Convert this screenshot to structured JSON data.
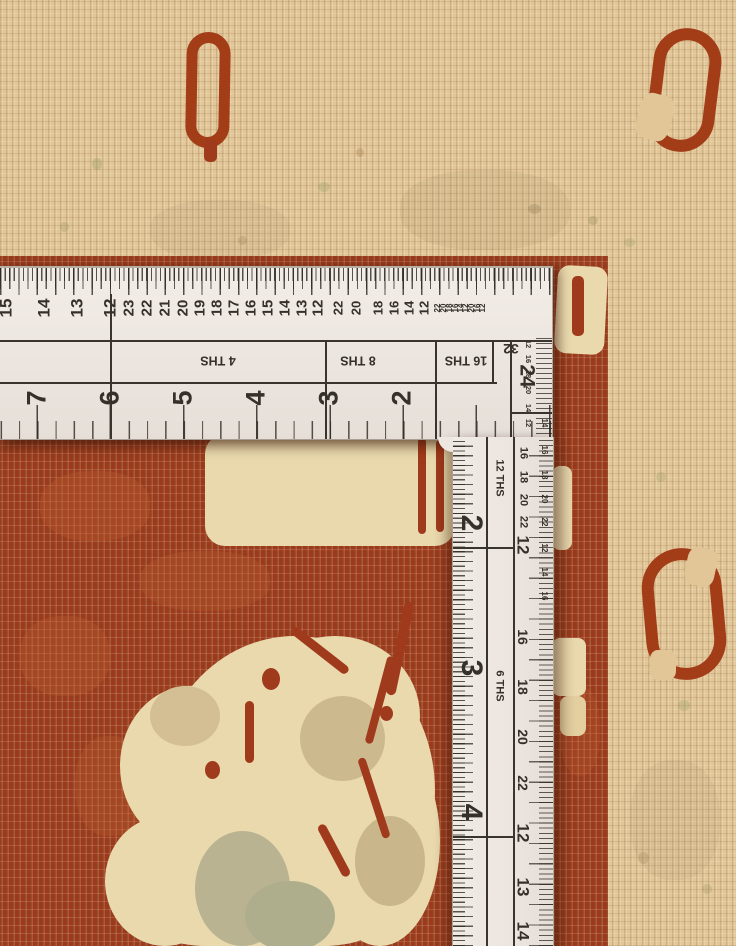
{
  "scene": {
    "description": "Close-up photo of a hand-knotted rug corner with an L-shaped steel framing square laid on it",
    "objects": [
      "rug",
      "framing-square-ruler"
    ]
  },
  "rug": {
    "colors": {
      "border_beige": "#e2c697",
      "field_red": "#9c3a1b",
      "motif_cream": "#e9d9ad",
      "accent_sage": "#b3ae88",
      "accent_tan": "#cdb98e",
      "motif_outline_red": "#a33d18"
    },
    "motifs": [
      "border-bud-top-left",
      "border-bud-top-right",
      "border-bud-right",
      "field-palmette",
      "field-edge-notches"
    ]
  },
  "ruler": {
    "colors": {
      "body": "#ece5df",
      "markings": "#36302a"
    },
    "horizontal_arm": {
      "top_scale": [
        {
          "v": "15",
          "x": 6,
          "cls": "f17"
        },
        {
          "v": "14",
          "x": 44,
          "cls": "f17"
        },
        {
          "v": "13",
          "x": 77,
          "cls": "f17"
        },
        {
          "v": "12",
          "x": 110,
          "cls": "f17"
        },
        {
          "v": "23",
          "x": 129,
          "cls": "f15"
        },
        {
          "v": "22",
          "x": 147,
          "cls": "f15"
        },
        {
          "v": "21",
          "x": 165,
          "cls": "f15"
        },
        {
          "v": "20",
          "x": 183,
          "cls": "f15"
        },
        {
          "v": "19",
          "x": 200,
          "cls": "f15"
        },
        {
          "v": "18",
          "x": 217,
          "cls": "f15"
        },
        {
          "v": "17",
          "x": 234,
          "cls": "f15"
        },
        {
          "v": "16",
          "x": 251,
          "cls": "f15"
        },
        {
          "v": "15",
          "x": 268,
          "cls": "f15"
        },
        {
          "v": "14",
          "x": 285,
          "cls": "f15"
        },
        {
          "v": "13",
          "x": 302,
          "cls": "f15"
        },
        {
          "v": "12",
          "x": 318,
          "cls": "f15"
        },
        {
          "v": "22",
          "x": 338,
          "cls": "f13"
        },
        {
          "v": "20",
          "x": 356,
          "cls": "f13"
        },
        {
          "v": "18",
          "x": 378,
          "cls": "f13"
        },
        {
          "v": "16",
          "x": 394,
          "cls": "f13"
        },
        {
          "v": "14",
          "x": 409,
          "cls": "f13"
        },
        {
          "v": "12",
          "x": 424,
          "cls": "f13"
        },
        {
          "v": "22",
          "x": 438,
          "cls": "f8"
        },
        {
          "v": "20",
          "x": 444,
          "cls": "f8"
        },
        {
          "v": "18",
          "x": 450,
          "cls": "f8"
        },
        {
          "v": "16",
          "x": 456,
          "cls": "f8"
        },
        {
          "v": "14",
          "x": 461,
          "cls": "f8"
        },
        {
          "v": "12",
          "x": 466,
          "cls": "f8"
        },
        {
          "v": "20",
          "x": 472,
          "cls": "f8"
        },
        {
          "v": "16",
          "x": 478,
          "cls": "f8"
        },
        {
          "v": "12",
          "x": 483,
          "cls": "f8"
        }
      ],
      "inch_numbers": [
        {
          "v": "7",
          "x": 37,
          "cls": "f27"
        },
        {
          "v": "6",
          "x": 110,
          "cls": "f27"
        },
        {
          "v": "5",
          "x": 183,
          "cls": "f27"
        },
        {
          "v": "4",
          "x": 256,
          "cls": "f27"
        },
        {
          "v": "3",
          "x": 329,
          "cls": "f27"
        },
        {
          "v": "2",
          "x": 402,
          "cls": "f27"
        }
      ],
      "fraction_cells": [
        {
          "v": "4 THS",
          "x": 218,
          "cls": "f12 r180"
        },
        {
          "v": "8 THS",
          "x": 358,
          "cls": "f12 r180"
        },
        {
          "v": "16 THS",
          "x": 466,
          "cls": "f12 r180"
        }
      ],
      "corner_labels": [
        {
          "v": "32",
          "x": 511,
          "y": 81,
          "cls": "f14 r180"
        },
        {
          "v": "24",
          "x": 527,
          "y": 108,
          "cls": "f20 r90"
        }
      ],
      "corner_tiny_numbers": [
        {
          "v": "12",
          "y": 76,
          "cls": "f7 r90"
        },
        {
          "v": "16",
          "y": 91,
          "cls": "f7 r90"
        },
        {
          "v": "18",
          "y": 106,
          "cls": "f7 r90"
        },
        {
          "v": "20",
          "y": 122,
          "cls": "f7 r90"
        },
        {
          "v": "14",
          "y": 140,
          "cls": "f7 r90"
        },
        {
          "v": "12",
          "y": 155,
          "cls": "f7 r90"
        }
      ]
    },
    "vertical_arm": {
      "inch_numbers": [
        {
          "v": "2",
          "y": 86,
          "cls": "f30 r90"
        },
        {
          "v": "3",
          "y": 231,
          "cls": "f30 r90"
        },
        {
          "v": "4",
          "y": 375,
          "cls": "f30 r90"
        }
      ],
      "fraction_labels": [
        {
          "v": "12 THS",
          "y": 41,
          "cls": "f11 r90"
        },
        {
          "v": "6 THS",
          "y": 249,
          "cls": "f11 r90"
        }
      ],
      "mid_numbers": [
        {
          "v": "16",
          "y": 16,
          "cls": "f11 r90"
        },
        {
          "v": "18",
          "y": 40,
          "cls": "f11 r90"
        },
        {
          "v": "20",
          "y": 63,
          "cls": "f11 r90"
        },
        {
          "v": "22",
          "y": 85,
          "cls": "f11 r90"
        },
        {
          "v": "12",
          "y": 108,
          "cls": "f17 r90"
        },
        {
          "v": "16",
          "y": 200,
          "cls": "f14 r90"
        },
        {
          "v": "18",
          "y": 250,
          "cls": "f14 r90"
        },
        {
          "v": "20",
          "y": 300,
          "cls": "f14 r90"
        },
        {
          "v": "22",
          "y": 346,
          "cls": "f14 r90"
        },
        {
          "v": "12",
          "y": 396,
          "cls": "f17 r90"
        },
        {
          "v": "13",
          "y": 450,
          "cls": "f17 r90"
        },
        {
          "v": "14",
          "y": 494,
          "cls": "f17 r90"
        }
      ],
      "edge_numbers": [
        {
          "v": "14",
          "y": -14,
          "cls": "f8 r90"
        },
        {
          "v": "16",
          "y": 13,
          "cls": "f8 r90"
        },
        {
          "v": "18",
          "y": 38,
          "cls": "f8 r90"
        },
        {
          "v": "20",
          "y": 62,
          "cls": "f8 r90"
        },
        {
          "v": "22",
          "y": 85,
          "cls": "f8 r90"
        },
        {
          "v": "12",
          "y": 111,
          "cls": "f8 r90"
        },
        {
          "v": "14",
          "y": 135,
          "cls": "f8 r90"
        },
        {
          "v": "16",
          "y": 159,
          "cls": "f8 r90"
        }
      ]
    }
  }
}
